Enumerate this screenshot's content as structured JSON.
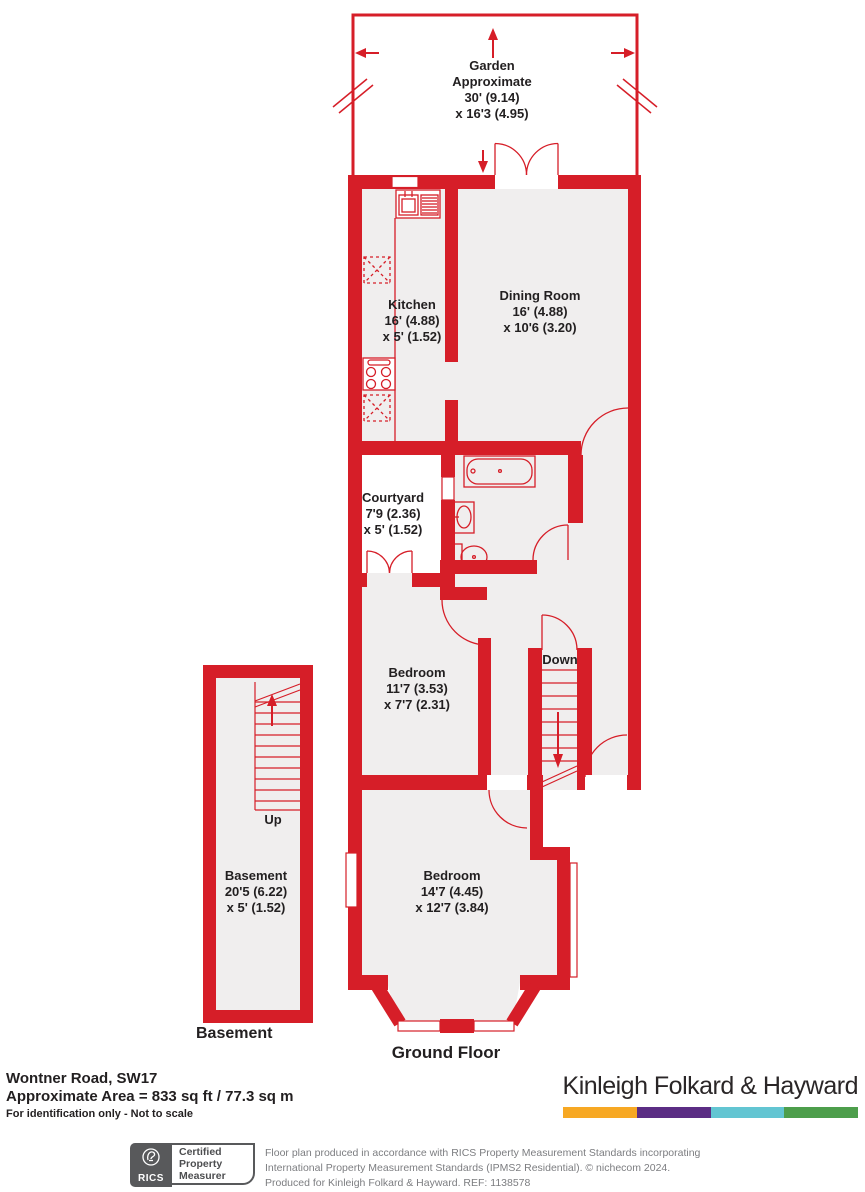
{
  "plan": {
    "colors": {
      "wall_red": "#D61E28",
      "interior_fill": "#F0EEEE",
      "outdoor_fill": "#FFFFFF"
    },
    "rooms": {
      "garden": {
        "lines": [
          "Garden",
          "Approximate",
          "30' (9.14)",
          "x 16'3 (4.95)"
        ]
      },
      "kitchen": {
        "name": "Kitchen",
        "dims1": "16' (4.88)",
        "dims2": "x 5' (1.52)"
      },
      "dining_room": {
        "name": "Dining Room",
        "dims1": "16' (4.88)",
        "dims2": "x 10'6 (3.20)"
      },
      "courtyard": {
        "name": "Courtyard",
        "dims1": "7'9 (2.36)",
        "dims2": "x 5' (1.52)"
      },
      "bedroom_mid": {
        "name": "Bedroom",
        "dims1": "11'7 (3.53)",
        "dims2": "x 7'7 (2.31)"
      },
      "bedroom_front": {
        "name": "Bedroom",
        "dims1": "14'7 (4.45)",
        "dims2": "x 12'7 (3.84)"
      },
      "basement_room": {
        "name": "Basement",
        "dims1": "20'5 (6.22)",
        "dims2": "x 5' (1.52)"
      }
    },
    "stairs": {
      "down": "Down",
      "up": "Up"
    },
    "floor_labels": {
      "basement": "Basement",
      "ground": "Ground Floor"
    }
  },
  "footer": {
    "address": "Wontner Road, SW17",
    "area": "Approximate Area = 833 sq ft / 77.3 sq m",
    "disclaimer": "For identification only - Not to scale"
  },
  "brand": {
    "name": "Kinleigh Folkard & Hayward",
    "bar_colors": [
      "#F7A823",
      "#5B2D84",
      "#62C5D2",
      "#4D9E4B"
    ]
  },
  "rics_badge": {
    "org": "RICS",
    "lines": [
      "Certified",
      "Property",
      "Measurer"
    ]
  },
  "legal": {
    "line1": "Floor plan produced in accordance with RICS Property Measurement Standards incorporating",
    "line2": "International Property Measurement Standards (IPMS2 Residential).   © nichecom 2024.",
    "line3": "Produced for Kinleigh Folkard & Hayward.    REF: 1138578"
  }
}
